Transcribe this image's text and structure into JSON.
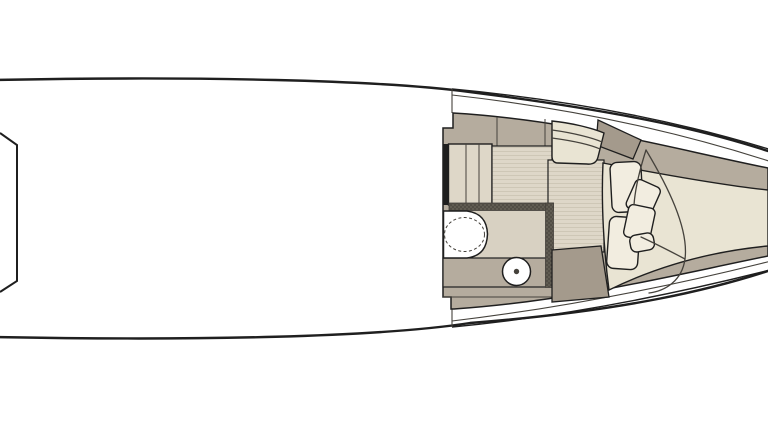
{
  "document": {
    "title": "Motor yacht bow cabin deck plan",
    "type": "top-view line-drawing floor plan",
    "visible_text": []
  },
  "palette": {
    "bg": "#ffffff",
    "ink": "#1f1f1f",
    "ink-soft": "#45423c",
    "taupe": "#b5ac9e",
    "taupe-dark": "#a49a8c",
    "floor": "#ded7c8",
    "floor-stripe": "#cbc3b2",
    "bath-floor": "#d8d1c2",
    "cream": "#e9e4d3",
    "pillow": "#f2ede0",
    "wall": "#514d45",
    "wall-dot": "#837d71"
  },
  "plan": {
    "items": [
      {
        "name": "hull"
      },
      {
        "name": "helm-console-partial"
      },
      {
        "name": "companionway-steps",
        "step_count": 3
      },
      {
        "name": "cabin-sole"
      },
      {
        "name": "head-compartment"
      },
      {
        "name": "toilet"
      },
      {
        "name": "wash-basin"
      },
      {
        "name": "vanity-counter"
      },
      {
        "name": "wardrobe-locker"
      },
      {
        "name": "seat-bench"
      },
      {
        "name": "side-cabinet"
      },
      {
        "name": "v-berth-bed"
      },
      {
        "name": "pillows",
        "count": 2
      },
      {
        "name": "cushions",
        "count": 2
      },
      {
        "name": "duvet"
      }
    ]
  }
}
